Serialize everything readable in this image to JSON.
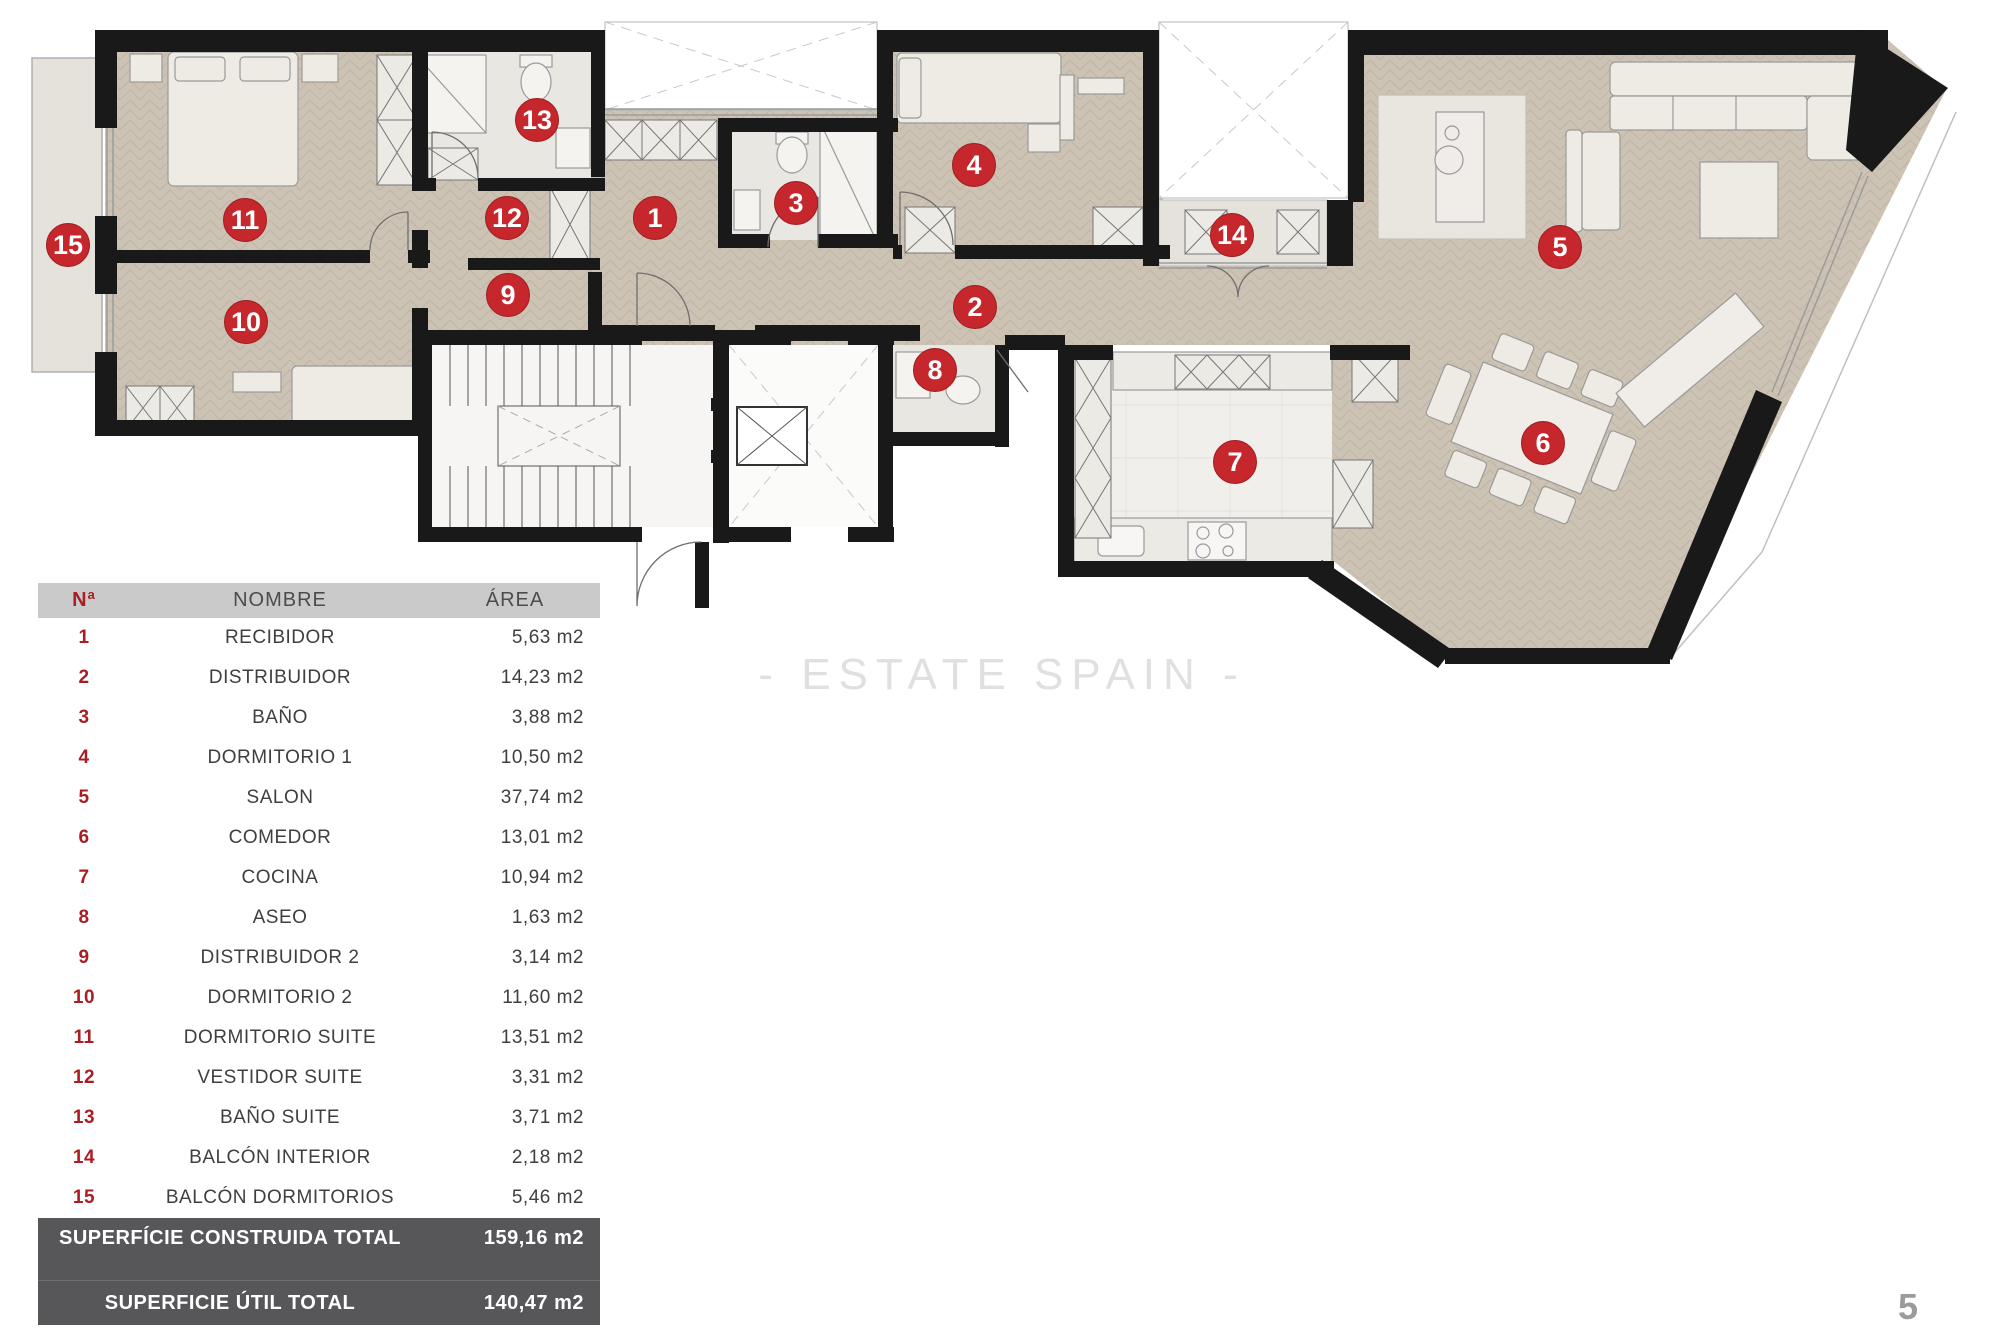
{
  "page": {
    "watermark": "- ESTATE SPAIN -",
    "number": "5"
  },
  "plan": {
    "marker_labels": [
      "1",
      "2",
      "3",
      "4",
      "5",
      "6",
      "7",
      "8",
      "9",
      "10",
      "11",
      "12",
      "13",
      "14",
      "15"
    ]
  },
  "table": {
    "headers": {
      "num": "Nª",
      "name": "NOMBRE",
      "area": "ÁREA"
    },
    "rows": [
      {
        "n": "1",
        "name": "RECIBIDOR",
        "area": "5,63 m2"
      },
      {
        "n": "2",
        "name": "DISTRIBUIDOR",
        "area": "14,23 m2"
      },
      {
        "n": "3",
        "name": "BAÑO",
        "area": "3,88 m2"
      },
      {
        "n": "4",
        "name": "DORMITORIO 1",
        "area": "10,50 m2"
      },
      {
        "n": "5",
        "name": "SALON",
        "area": "37,74 m2"
      },
      {
        "n": "6",
        "name": "COMEDOR",
        "area": "13,01 m2"
      },
      {
        "n": "7",
        "name": "COCINA",
        "area": "10,94 m2"
      },
      {
        "n": "8",
        "name": "ASEO",
        "area": "1,63 m2"
      },
      {
        "n": "9",
        "name": "DISTRIBUIDOR 2",
        "area": "3,14 m2"
      },
      {
        "n": "10",
        "name": "DORMITORIO 2",
        "area": "11,60 m2"
      },
      {
        "n": "11",
        "name": "DORMITORIO SUITE",
        "area": "13,51 m2"
      },
      {
        "n": "12",
        "name": "VESTIDOR SUITE",
        "area": "3,31 m2"
      },
      {
        "n": "13",
        "name": "BAÑO SUITE",
        "area": "3,71 m2"
      },
      {
        "n": "14",
        "name": "BALCÓN INTERIOR",
        "area": "2,18 m2"
      },
      {
        "n": "15",
        "name": "BALCÓN DORMITORIOS",
        "area": "5,46 m2"
      }
    ],
    "totals": [
      {
        "label": "SUPERFÍCIE CONSTRUIDA TOTAL",
        "value": "159,16 m2"
      },
      {
        "label": "SUPERFICIE ÚTIL TOTAL",
        "value": "140,47 m2"
      }
    ]
  }
}
